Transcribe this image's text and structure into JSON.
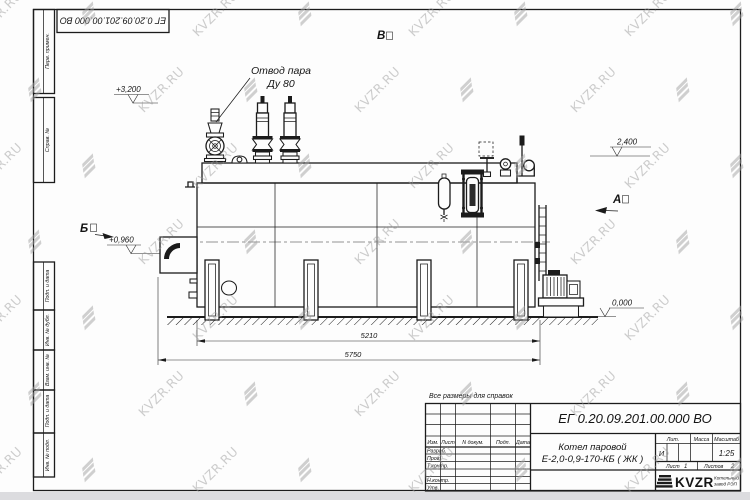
{
  "sheet": {
    "rotated_doc_number": "ЕГ 0.20.09.201.00.000  ВО",
    "note_all_dims": "Все размеры для справок",
    "format_label": "Формат А3",
    "stamps_top": [
      "Перв. примен.",
      "Справ. №"
    ],
    "stamps_bottom": [
      "Подп. и дата",
      "Инв. № дубл.",
      "Взам. инв. №",
      "Подп. и дата",
      "Инв. № подл."
    ]
  },
  "drawing": {
    "callout_line1": "Отвод пара",
    "callout_line2": "Ду 80",
    "elev_3200": "+3,200",
    "elev_2400": "2,400",
    "elev_0960": "+0,960",
    "elev_0000": "0,000",
    "view_b": "Б",
    "view_a": "А",
    "view_v": "В",
    "dim_5210": "5210",
    "dim_5750": "5750"
  },
  "title_block": {
    "doc_number": "ЕГ 0.20.09.201.00.000  ВО",
    "cols": [
      "Изм.",
      "Лист",
      "N докум.",
      "Подп.",
      "Дата"
    ],
    "rows": [
      "Разраб.",
      "Пров.",
      "Т.контр.",
      "Н.контр.",
      "Утв."
    ],
    "product_line1": "Котел паровой",
    "product_line2": "Е-2,0-0,9-170-КБ ( ЖК )",
    "lit_label": "Лит.",
    "lit_value": "И",
    "mass_label": "Масса",
    "scale_label": "Масштаб",
    "scale_value": "1:25",
    "sheet_label": "Лист",
    "sheet_value": "1",
    "sheets_label": "Листов",
    "sheets_value": "2",
    "company_name": "KVZR",
    "company_note1": "Котельный",
    "company_note2": "завод РЭП"
  },
  "watermark": {
    "text": "KVZR.RU"
  }
}
